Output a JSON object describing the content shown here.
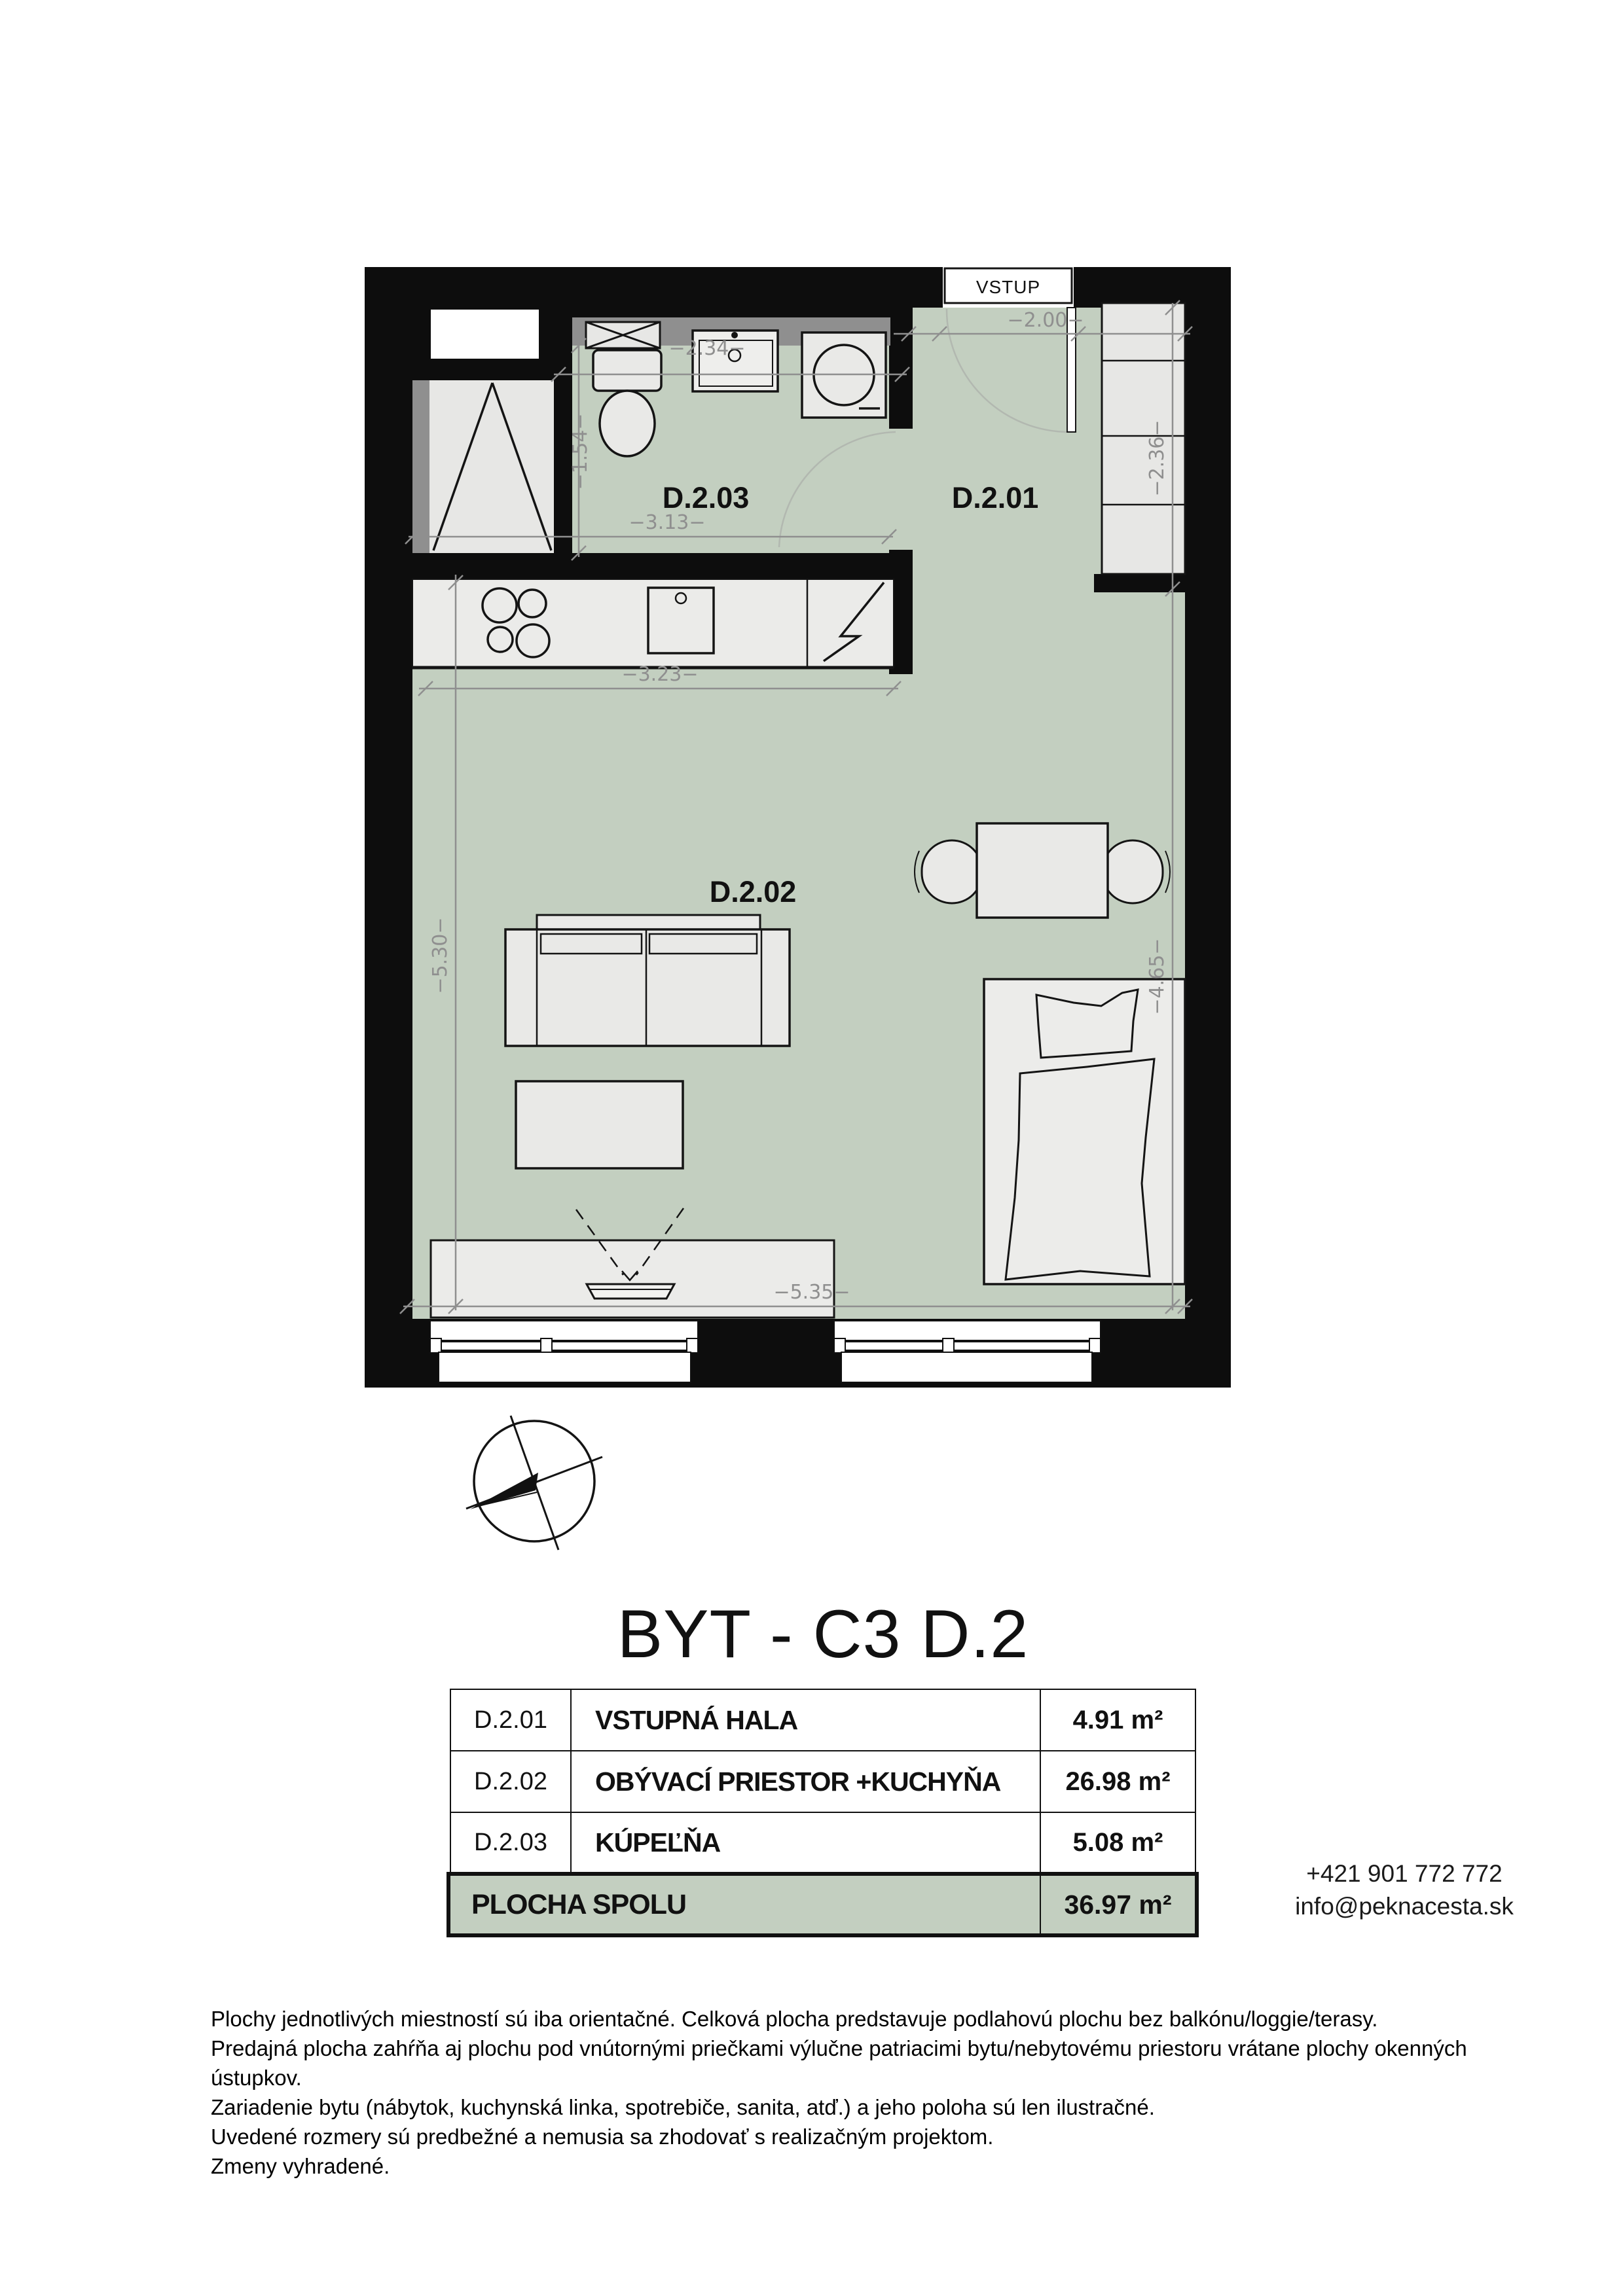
{
  "title": "BYT - C3 D.2",
  "plan": {
    "entrance_label": "VSTUP",
    "room_labels": {
      "hall": "D.2.01",
      "living": "D.2.02",
      "bath": "D.2.03"
    },
    "dimensions": {
      "entry_width": "−2.00−",
      "vanity_width": "−2.34−",
      "bath_height": "−1.54−",
      "bath_width": "−3.13−",
      "kitchen_width": "−3.23−",
      "left_height": "−5.30−",
      "wardrobe_height": "−2.36−",
      "living_height": "−4.65−",
      "bottom_width": "−5.35−"
    },
    "colors": {
      "floor": "#c3cfc0",
      "wall": "#0d0d0d",
      "furniture": "#e9e9e7",
      "dimension": "#8f8f8f",
      "counter_strip": "#8f8f8f"
    }
  },
  "table": {
    "rows": [
      {
        "code": "D.2.01",
        "name": "VSTUPNÁ HALA",
        "area": "4.91 m²"
      },
      {
        "code": "D.2.02",
        "name": "OBÝVACÍ PRIESTOR +KUCHYŇA",
        "area": "26.98 m²"
      },
      {
        "code": "D.2.03",
        "name": "KÚPEĽŇA",
        "area": "5.08 m²"
      }
    ],
    "total": {
      "label": "PLOCHA SPOLU",
      "area": "36.97 m²"
    }
  },
  "contact": {
    "phone": "+421 901 772 772",
    "email": "info@peknacesta.sk"
  },
  "disclaimer": [
    "Plochy jednotlivých miestností sú iba orientačné. Celková plocha predstavuje podlahovú plochu bez balkónu/loggie/terasy.",
    "Predajná plocha zahŕňa aj plochu pod vnútornými priečkami výlučne patriacimi bytu/nebytovému priestoru vrátane plochy okenných ústupkov.",
    "Zariadenie bytu (nábytok, kuchynská linka, spotrebiče, sanita, atď.) a jeho poloha sú len ilustračné.",
    "Uvedené rozmery sú predbežné a nemusia sa zhodovať s realizačným projektom.",
    "Zmeny vyhradené."
  ]
}
